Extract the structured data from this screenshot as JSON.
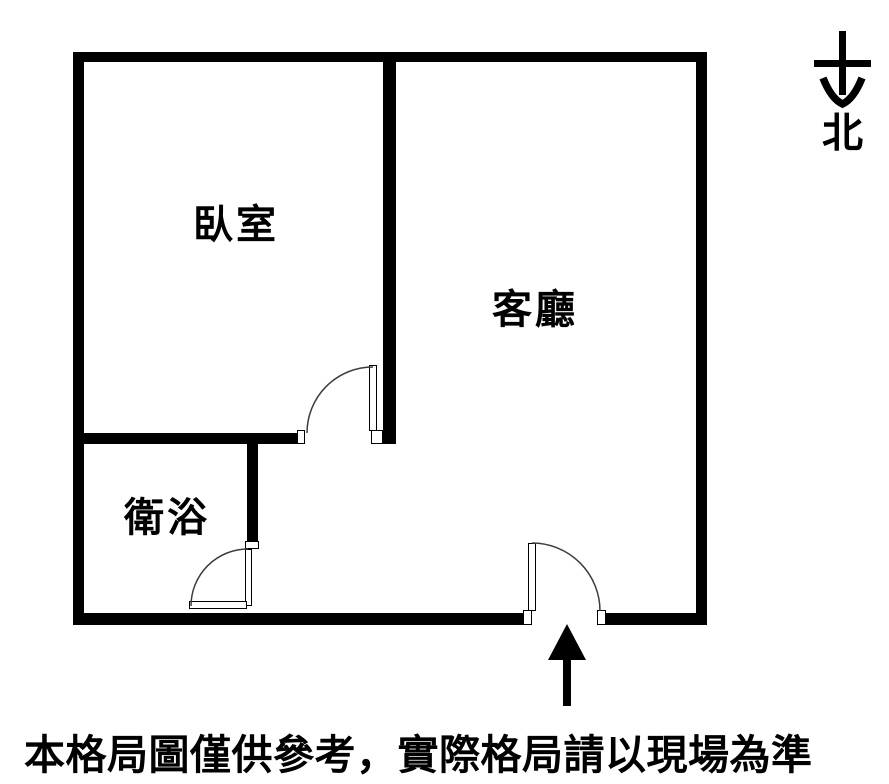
{
  "floor_plan": {
    "rooms": [
      {
        "name": "bedroom",
        "label": "臥室"
      },
      {
        "name": "living-room",
        "label": "客廳"
      },
      {
        "name": "bathroom",
        "label": "衛浴"
      }
    ],
    "doors": [
      "bedroom-door",
      "bathroom-door",
      "entrance-door"
    ],
    "compass": {
      "label": "北",
      "icon": "arrow-down"
    },
    "entrance": {
      "icon": "arrow-up"
    }
  },
  "disclaimer": "本格局圖僅供參考，實際格局請以現場為準",
  "colors": {
    "wall": "#000000",
    "background": "#ffffff",
    "door_arc": "#3c3c3c",
    "text": "#000000"
  }
}
